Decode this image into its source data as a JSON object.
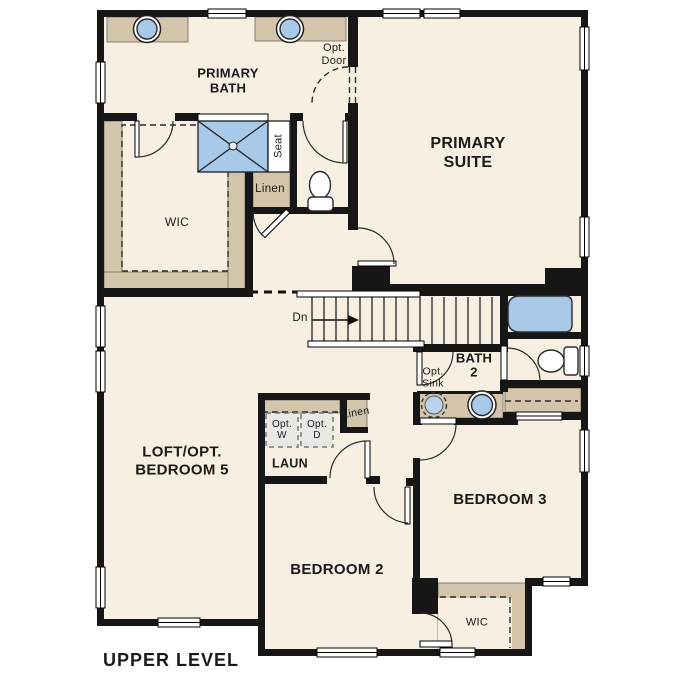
{
  "plan": {
    "title": "UPPER LEVEL",
    "level_name": "Upper Level floor plan"
  },
  "labels": {
    "primary_bath": "PRIMARY\nBATH",
    "primary_suite": "PRIMARY\nSUITE",
    "opt_door": "Opt.\nDoor",
    "seat": "Seat",
    "linen_bath": "Linen",
    "wic_primary": "WIC",
    "stairs_down": "Dn",
    "bath2": "BATH\n2",
    "opt_sink": "Opt.\nSink",
    "loft": "LOFT/OPT.\nBEDROOM 5",
    "opt_washer": "Opt.\nW",
    "opt_dryer": "Opt.\nD",
    "laundry": "LAUN",
    "linen_hall": "Linen",
    "bedroom2": "BEDROOM 2",
    "bedroom3": "BEDROOM 3",
    "wic_bedroom2": "WIC",
    "plan_title": "UPPER LEVEL"
  },
  "colors": {
    "wall_color": "#161616",
    "floor_color": "#f6efe2",
    "casework_color": "#d2c5ac",
    "fixture_color": "#a9c9e9",
    "appliance_color": "#e9e8e4",
    "background_color": "#ffffff",
    "text_color": "#1a1a1a"
  }
}
